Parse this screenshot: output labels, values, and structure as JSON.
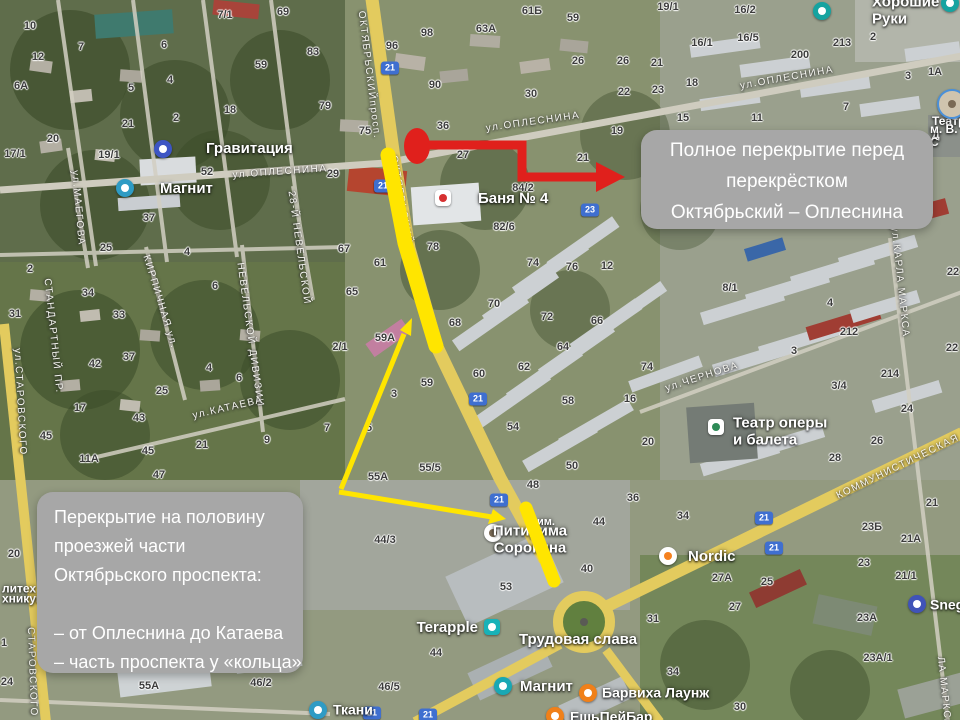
{
  "colors": {
    "annotation_red": "#e0201c",
    "annotation_yellow": "#ffe500",
    "callout_bg": "#a7a7a7",
    "callout_text": "#ffffff",
    "shield_bg": "#3f6fd0"
  },
  "callouts": {
    "full_closure": {
      "lines": [
        "Полное перекрытие перед",
        "перекрёстком",
        "Октябрьский – Оплеснина"
      ]
    },
    "half_closure": {
      "lines": [
        "Перекрытие на половину",
        "проезжей части",
        "Октябрьского проспекта:",
        "",
        "– от Оплеснина до Катаева",
        "– часть проспекта у «кольца»"
      ]
    }
  },
  "map": {
    "road_shields": [
      [
        390,
        68,
        "21"
      ],
      [
        383,
        186,
        "21"
      ],
      [
        478,
        399,
        "21"
      ],
      [
        499,
        500,
        "21"
      ],
      [
        372,
        713,
        "21"
      ],
      [
        428,
        715,
        "21"
      ],
      [
        764,
        518,
        "21"
      ],
      [
        774,
        548,
        "21"
      ],
      [
        590,
        210,
        "23"
      ]
    ],
    "street_labels": [
      [
        369,
        75,
        83,
        "ОКТЯБРЬСКИЙпросп."
      ],
      [
        401,
        200,
        80,
        "ОКТЯБРЬСКИЙ"
      ],
      [
        280,
        172,
        -4,
        "ул.ОПЛЕСНИНА"
      ],
      [
        533,
        122,
        -8,
        "ул.ОПЛЕСНИНА"
      ],
      [
        787,
        78,
        -10,
        "ул.ОПЛЕСНИНА"
      ],
      [
        78,
        208,
        85,
        "ул.МАЕГОВА"
      ],
      [
        20,
        402,
        87,
        "ул.СТАРОВСКОГО"
      ],
      [
        32,
        672,
        88,
        "СТАРОВСКОГО"
      ],
      [
        53,
        336,
        84,
        "СТАНДАРТНЫЙ ПР."
      ],
      [
        160,
        302,
        73,
        "КИРПИЧНАЯ ул."
      ],
      [
        250,
        335,
        82,
        "НЕВЕЛЬСКОЙ ДИВИЗИИ"
      ],
      [
        299,
        248,
        82,
        "28-Й НЕВЕЛЬСКОЙ"
      ],
      [
        228,
        408,
        -13,
        "ул.КАТАЕВА"
      ],
      [
        702,
        377,
        -18,
        "ул.ЧЕРНОВА"
      ],
      [
        900,
        282,
        84,
        "ул.КАРЛА МАРКСА"
      ],
      [
        944,
        692,
        84,
        "ЛА МАРКСА"
      ],
      [
        908,
        462,
        -26,
        "КОММУНИСТИЧЕСКАЯ ул."
      ]
    ],
    "building_numbers": [
      [
        30,
        26,
        "10"
      ],
      [
        38,
        57,
        "12"
      ],
      [
        21,
        86,
        "6А"
      ],
      [
        81,
        47,
        "7"
      ],
      [
        164,
        45,
        "6"
      ],
      [
        225,
        15,
        "7/1"
      ],
      [
        283,
        12,
        "69"
      ],
      [
        313,
        52,
        "83"
      ],
      [
        261,
        65,
        "59"
      ],
      [
        131,
        88,
        "5"
      ],
      [
        170,
        80,
        "4"
      ],
      [
        230,
        110,
        "18"
      ],
      [
        176,
        118,
        "2"
      ],
      [
        128,
        124,
        "21"
      ],
      [
        53,
        139,
        "20"
      ],
      [
        15,
        154,
        "17/1"
      ],
      [
        109,
        155,
        "19/1"
      ],
      [
        207,
        172,
        "52"
      ],
      [
        149,
        218,
        "37"
      ],
      [
        427,
        33,
        "98"
      ],
      [
        392,
        46,
        "96"
      ],
      [
        486,
        29,
        "63А"
      ],
      [
        532,
        11,
        "61Б"
      ],
      [
        573,
        18,
        "59"
      ],
      [
        435,
        85,
        "90"
      ],
      [
        531,
        94,
        "30"
      ],
      [
        578,
        61,
        "26"
      ],
      [
        623,
        61,
        "26"
      ],
      [
        624,
        92,
        "22"
      ],
      [
        325,
        106,
        "79"
      ],
      [
        365,
        131,
        "75"
      ],
      [
        443,
        126,
        "36"
      ],
      [
        617,
        131,
        "19"
      ],
      [
        463,
        155,
        "27"
      ],
      [
        583,
        158,
        "21"
      ],
      [
        333,
        174,
        "29"
      ],
      [
        523,
        188,
        "84/2"
      ],
      [
        504,
        227,
        "82/6"
      ],
      [
        668,
        7,
        "19/1"
      ],
      [
        745,
        10,
        "16/2"
      ],
      [
        702,
        43,
        "16/1"
      ],
      [
        748,
        38,
        "16/5"
      ],
      [
        842,
        43,
        "213"
      ],
      [
        873,
        37,
        "2"
      ],
      [
        800,
        55,
        "200"
      ],
      [
        657,
        63,
        "21"
      ],
      [
        935,
        72,
        "1А"
      ],
      [
        908,
        76,
        "3"
      ],
      [
        692,
        83,
        "18"
      ],
      [
        658,
        90,
        "23"
      ],
      [
        683,
        118,
        "15"
      ],
      [
        757,
        118,
        "11"
      ],
      [
        846,
        107,
        "7"
      ],
      [
        106,
        248,
        "25"
      ],
      [
        187,
        252,
        "4"
      ],
      [
        30,
        269,
        "2"
      ],
      [
        88,
        293,
        "34"
      ],
      [
        215,
        286,
        "6"
      ],
      [
        15,
        314,
        "31"
      ],
      [
        119,
        315,
        "33"
      ],
      [
        129,
        357,
        "37"
      ],
      [
        95,
        364,
        "42"
      ],
      [
        209,
        368,
        "4"
      ],
      [
        239,
        378,
        "6"
      ],
      [
        162,
        391,
        "25"
      ],
      [
        80,
        408,
        "17"
      ],
      [
        139,
        418,
        "43"
      ],
      [
        46,
        436,
        "45"
      ],
      [
        202,
        445,
        "21"
      ],
      [
        267,
        440,
        "9"
      ],
      [
        89,
        459,
        "11А"
      ],
      [
        148,
        451,
        "45"
      ],
      [
        159,
        475,
        "47"
      ],
      [
        344,
        249,
        "67"
      ],
      [
        380,
        263,
        "61"
      ],
      [
        433,
        247,
        "78"
      ],
      [
        533,
        263,
        "74"
      ],
      [
        572,
        267,
        "76"
      ],
      [
        607,
        266,
        "12"
      ],
      [
        352,
        292,
        "65"
      ],
      [
        494,
        304,
        "70"
      ],
      [
        547,
        317,
        "72"
      ],
      [
        597,
        321,
        "66"
      ],
      [
        455,
        323,
        "68"
      ],
      [
        385,
        338,
        "59А"
      ],
      [
        340,
        347,
        "2/1"
      ],
      [
        563,
        347,
        "64"
      ],
      [
        524,
        367,
        "62"
      ],
      [
        479,
        374,
        "60"
      ],
      [
        427,
        383,
        "59"
      ],
      [
        394,
        394,
        "3"
      ],
      [
        568,
        401,
        "58"
      ],
      [
        630,
        399,
        "16"
      ],
      [
        369,
        428,
        "5"
      ],
      [
        327,
        428,
        "7"
      ],
      [
        513,
        427,
        "54"
      ],
      [
        430,
        468,
        "55/5"
      ],
      [
        378,
        477,
        "55А"
      ],
      [
        572,
        466,
        "50"
      ],
      [
        730,
        288,
        "8/1"
      ],
      [
        830,
        303,
        "4"
      ],
      [
        849,
        332,
        "212"
      ],
      [
        794,
        351,
        "3"
      ],
      [
        647,
        367,
        "74"
      ],
      [
        890,
        374,
        "214"
      ],
      [
        839,
        386,
        "3/4"
      ],
      [
        907,
        409,
        "24"
      ],
      [
        648,
        442,
        "20"
      ],
      [
        877,
        441,
        "26"
      ],
      [
        835,
        458,
        "28"
      ],
      [
        953,
        272,
        "22"
      ],
      [
        952,
        348,
        "22"
      ],
      [
        14,
        554,
        "20"
      ],
      [
        7,
        682,
        "24"
      ],
      [
        4,
        643,
        "1"
      ],
      [
        149,
        686,
        "55А"
      ],
      [
        261,
        683,
        "46/2"
      ],
      [
        533,
        485,
        "48"
      ],
      [
        633,
        498,
        "36"
      ],
      [
        599,
        522,
        "44"
      ],
      [
        385,
        540,
        "44/3"
      ],
      [
        587,
        569,
        "40"
      ],
      [
        506,
        587,
        "53"
      ],
      [
        436,
        653,
        "44"
      ],
      [
        389,
        687,
        "46/5"
      ],
      [
        683,
        516,
        "34"
      ],
      [
        872,
        527,
        "23Б"
      ],
      [
        932,
        503,
        "21"
      ],
      [
        911,
        539,
        "21А"
      ],
      [
        864,
        563,
        "23"
      ],
      [
        906,
        576,
        "21/1"
      ],
      [
        722,
        578,
        "27А"
      ],
      [
        767,
        582,
        "25"
      ],
      [
        735,
        607,
        "27"
      ],
      [
        653,
        619,
        "31"
      ],
      [
        867,
        618,
        "23А"
      ],
      [
        878,
        658,
        "23А/1"
      ],
      [
        673,
        672,
        "34"
      ],
      [
        740,
        707,
        "30"
      ]
    ],
    "pois": [
      {
        "t": "Гравитация",
        "x": 206,
        "y": 149,
        "size": 15,
        "ix": 163,
        "iy": 149,
        "shape": "circle",
        "bg": "#3d55c4",
        "dot": "#ffffff"
      },
      {
        "t": "Магнит",
        "x": 160,
        "y": 189,
        "size": 15,
        "ix": 125,
        "iy": 188,
        "shape": "circle",
        "bg": "#2e9bc4",
        "dot": "#ffffff"
      },
      {
        "t": "Баня № 4",
        "x": 478,
        "y": 199,
        "size": 15,
        "ix": 443,
        "iy": 198,
        "shape": "rsq",
        "bg": "#ffffff",
        "dot": "#d63031"
      },
      {
        "t": "Хорошие Руки",
        "x": 872,
        "y": 11,
        "size": 15,
        "ix": 822,
        "iy": 11,
        "shape": "circle",
        "bg": "#16a3a0",
        "dot": "#ffffff"
      },
      {
        "t": "Театр оперы\nи балета",
        "x": 733,
        "y": 432,
        "size": 15,
        "ix": 716,
        "iy": 427,
        "shape": "rsq",
        "bg": "#ffffff",
        "dot": "#2e8b57"
      },
      {
        "t": "Nordic",
        "x": 688,
        "y": 557,
        "size": 15,
        "ix": 668,
        "iy": 556,
        "shape": "circle",
        "bg": "#ffffff",
        "dot": "#f5821f"
      },
      {
        "t": "Snegir",
        "x": 930,
        "y": 605,
        "ix": 917,
        "iy": 604,
        "shape": "circle",
        "bg": "#4053b8",
        "dot": "#ffffff"
      },
      {
        "t": "Terapple",
        "x": 478,
        "y": 628,
        "size": 15,
        "anchor": "right",
        "ix": 492,
        "iy": 627,
        "shape": "rsq",
        "bg": "#18b2b8",
        "dot": "#ffffff"
      },
      {
        "t": "Магнит",
        "x": 520,
        "y": 687,
        "size": 15,
        "ix": 503,
        "iy": 686,
        "shape": "circle",
        "bg": "#19a8b4",
        "dot": "#ffffff"
      },
      {
        "t": "Барвиха Лаунж",
        "x": 602,
        "y": 693,
        "ix": 588,
        "iy": 693,
        "shape": "circle",
        "bg": "#f08019",
        "dot": "#ffffff"
      },
      {
        "t": "ЕшьПейБар",
        "x": 570,
        "y": 717,
        "ix": 555,
        "iy": 716,
        "shape": "circle",
        "bg": "#f08019",
        "dot": "#ffffff"
      },
      {
        "t": "Ткани",
        "x": 333,
        "y": 710,
        "ix": 318,
        "iy": 710,
        "shape": "circle",
        "bg": "#2e9bc4",
        "dot": "#ffffff"
      },
      {
        "t": "Питирима\nСорокина",
        "x": 530,
        "y": 540,
        "size": 15,
        "anchor": "center",
        "ix": 493,
        "iy": 533,
        "shape": "circle",
        "bg": "#ffffff",
        "dot": "#7a6a55"
      },
      {
        "t": "им.",
        "x": 537,
        "y": 522,
        "size": 11
      },
      {
        "t": "Трудовая слава",
        "x": 578,
        "y": 640,
        "size": 15,
        "anchor": "center"
      },
      {
        "t": "литех",
        "x": 2,
        "y": 589,
        "size": 12
      },
      {
        "t": "хникум",
        "x": 2,
        "y": 599,
        "size": 12
      },
      {
        "t": "Театр д",
        "x": 932,
        "y": 128,
        "size": 12
      },
      {
        "t": "м. В. С",
        "x": 930,
        "y": 136,
        "size": 12
      },
      {
        "ix": 952,
        "iy": 104,
        "r": 26,
        "shape": "circle",
        "bg": "#cfc4ae",
        "dot": "#7a6a55",
        "ring": "#4a90d9"
      },
      {
        "ix": 950,
        "iy": 3,
        "shape": "circle",
        "bg": "#16a3a0",
        "dot": "#ffffff"
      }
    ]
  }
}
